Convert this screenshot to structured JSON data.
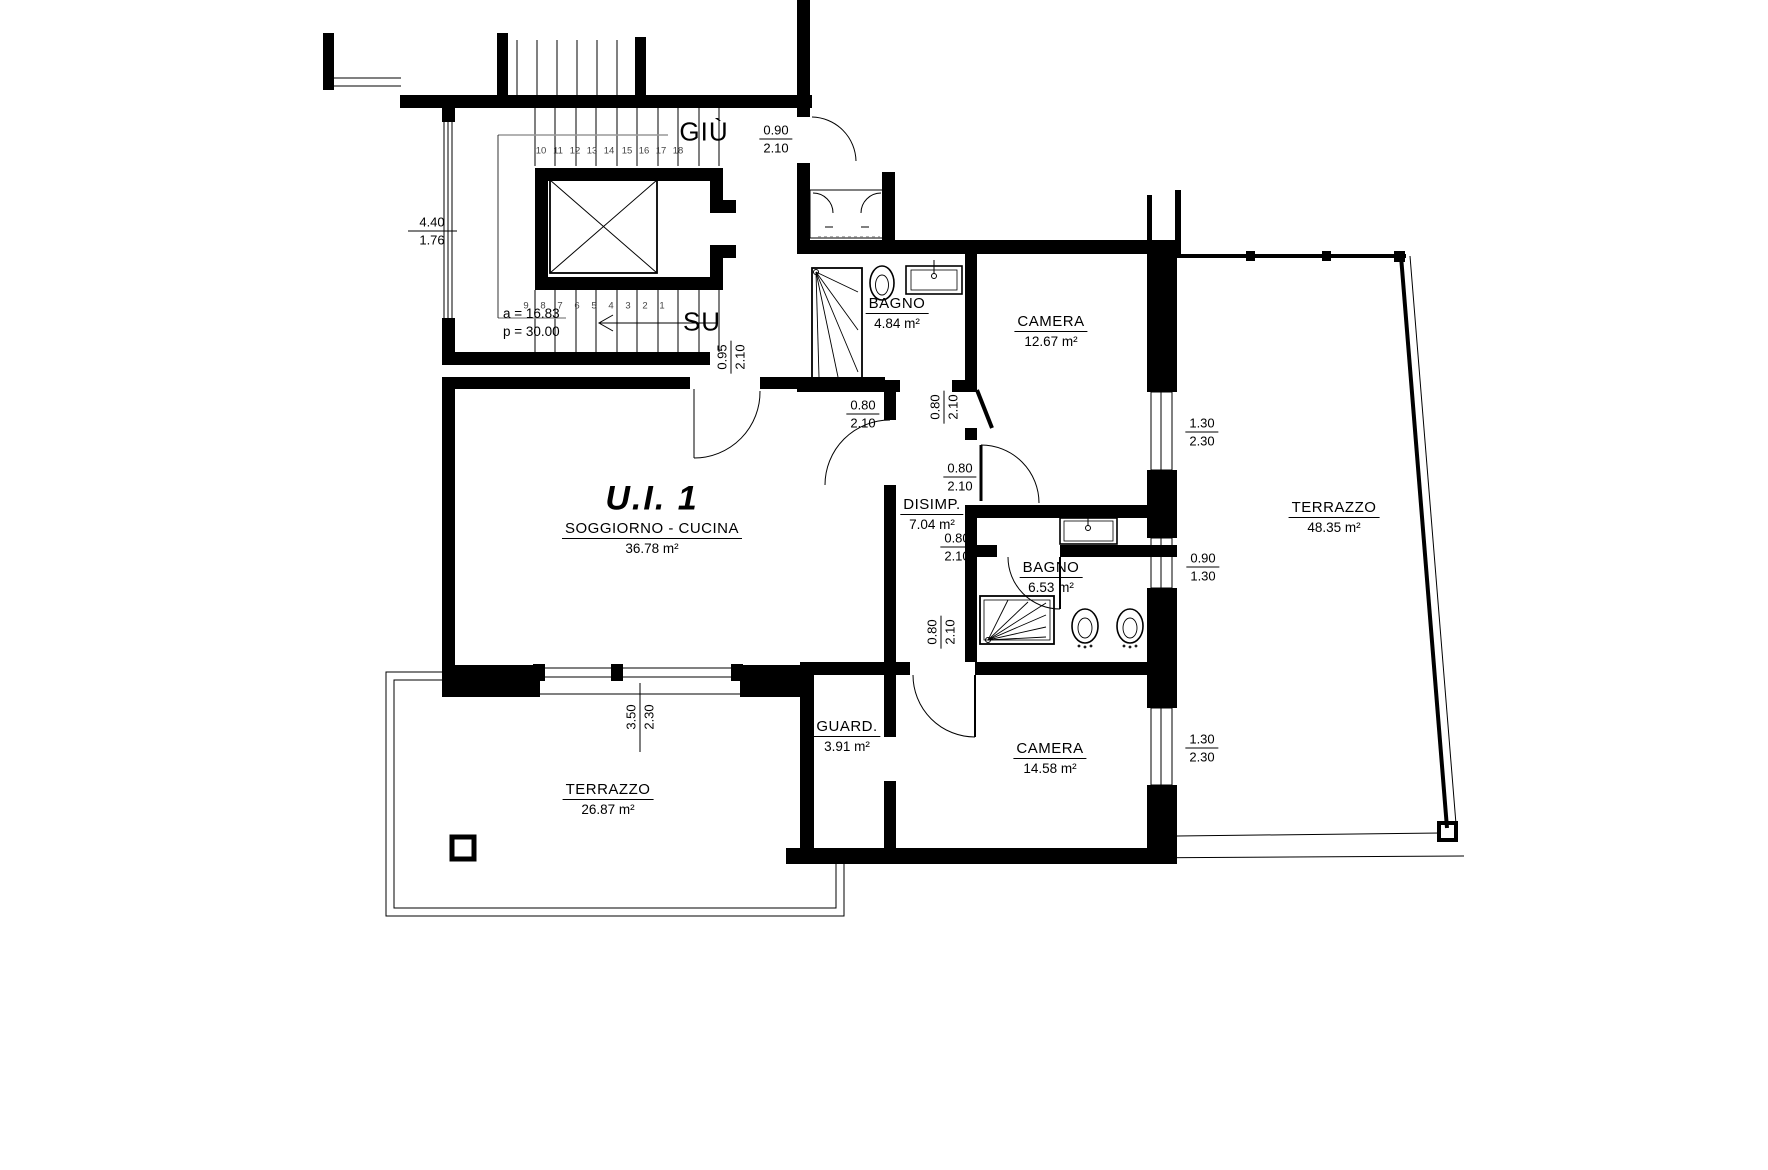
{
  "plan": {
    "unit_label": "U.I. 1",
    "rooms": [
      {
        "name": "SOGGIORNO - CUCINA",
        "area": "36.78 m²"
      },
      {
        "name": "BAGNO",
        "area": "4.84 m²"
      },
      {
        "name": "CAMERA",
        "area": "12.67 m²"
      },
      {
        "name": "DISIMP.",
        "area": "7.04 m²"
      },
      {
        "name": "BAGNO",
        "area": "6.53 m²"
      },
      {
        "name": "TERRAZZO",
        "area": "48.35 m²"
      },
      {
        "name": "GUARD.",
        "area": "3.91 m²"
      },
      {
        "name": "CAMERA",
        "area": "14.58 m²"
      },
      {
        "name": "TERRAZZO",
        "area": "26.87 m²"
      }
    ],
    "stairs": {
      "down_label": "GIÙ",
      "up_label": "SU",
      "note_a": "a = 16.83",
      "note_p": "p = 30.00",
      "steps_up": [
        "10",
        "11",
        "12",
        "13",
        "14",
        "15",
        "16",
        "17",
        "18"
      ],
      "steps_down": [
        "9",
        "8",
        "7",
        "6",
        "5",
        "4",
        "3",
        "2",
        "1"
      ]
    },
    "dims": [
      {
        "top": "4.40",
        "bottom": "1.76"
      },
      {
        "top": "0.90",
        "bottom": "2.10"
      },
      {
        "top": "0.95",
        "bottom": "2.10"
      },
      {
        "top": "0.80",
        "bottom": "2.10"
      },
      {
        "top": "0.80",
        "bottom": "2.10"
      },
      {
        "top": "0.80",
        "bottom": "2.10"
      },
      {
        "top": "0.80",
        "bottom": "2.10"
      },
      {
        "top": "0.80",
        "bottom": "2.10"
      },
      {
        "top": "1.30",
        "bottom": "2.30"
      },
      {
        "top": "0.90",
        "bottom": "1.30"
      },
      {
        "top": "1.30",
        "bottom": "2.30"
      },
      {
        "top": "3.50",
        "bottom": "2.30"
      }
    ],
    "colors": {
      "wall": "#000000",
      "leader": "#999999",
      "background": "#ffffff"
    }
  }
}
